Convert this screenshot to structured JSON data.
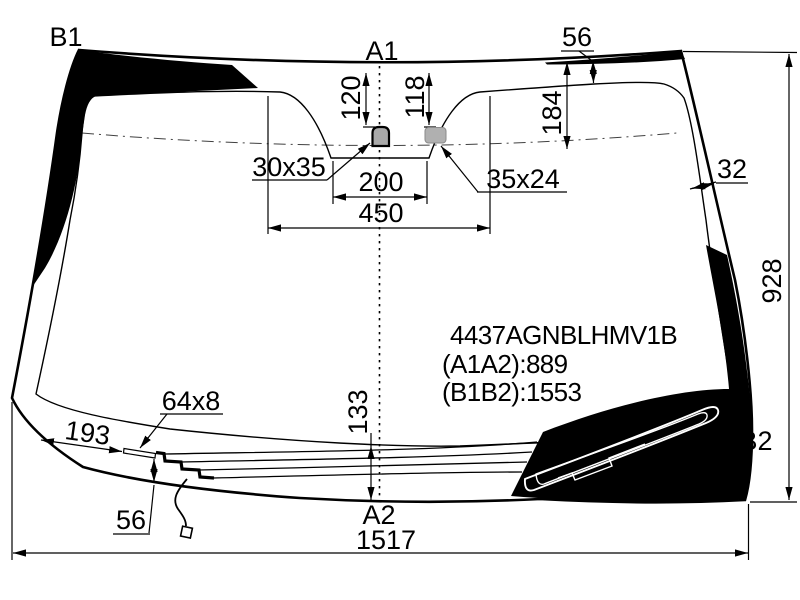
{
  "glass_points": {
    "b1": "B1",
    "a1": "A1",
    "a2": "A2",
    "b2": "B2"
  },
  "part_info": {
    "part_number": "4437AGNBLHMV1B",
    "a1a2_distance": "(A1A2):889",
    "b1b2_distance": "(B1B2):1553"
  },
  "dims": {
    "top_band": "56",
    "mirror_down": "120",
    "sensor_down": "118",
    "shade_band_depth": "184",
    "mirror_mount_size": "30x35",
    "mount_span": "200",
    "cutout_span": "450",
    "sensor_size": "35x24",
    "side_band": "32",
    "height": "928",
    "strip_size": "64x8",
    "strip_from_edge": "193",
    "center_bottom": "133",
    "bottom_gap": "56",
    "width": "1517"
  },
  "colors": {
    "ink": "#000000",
    "paper": "#ffffff",
    "hardware_gray": "#a9a9a9"
  }
}
